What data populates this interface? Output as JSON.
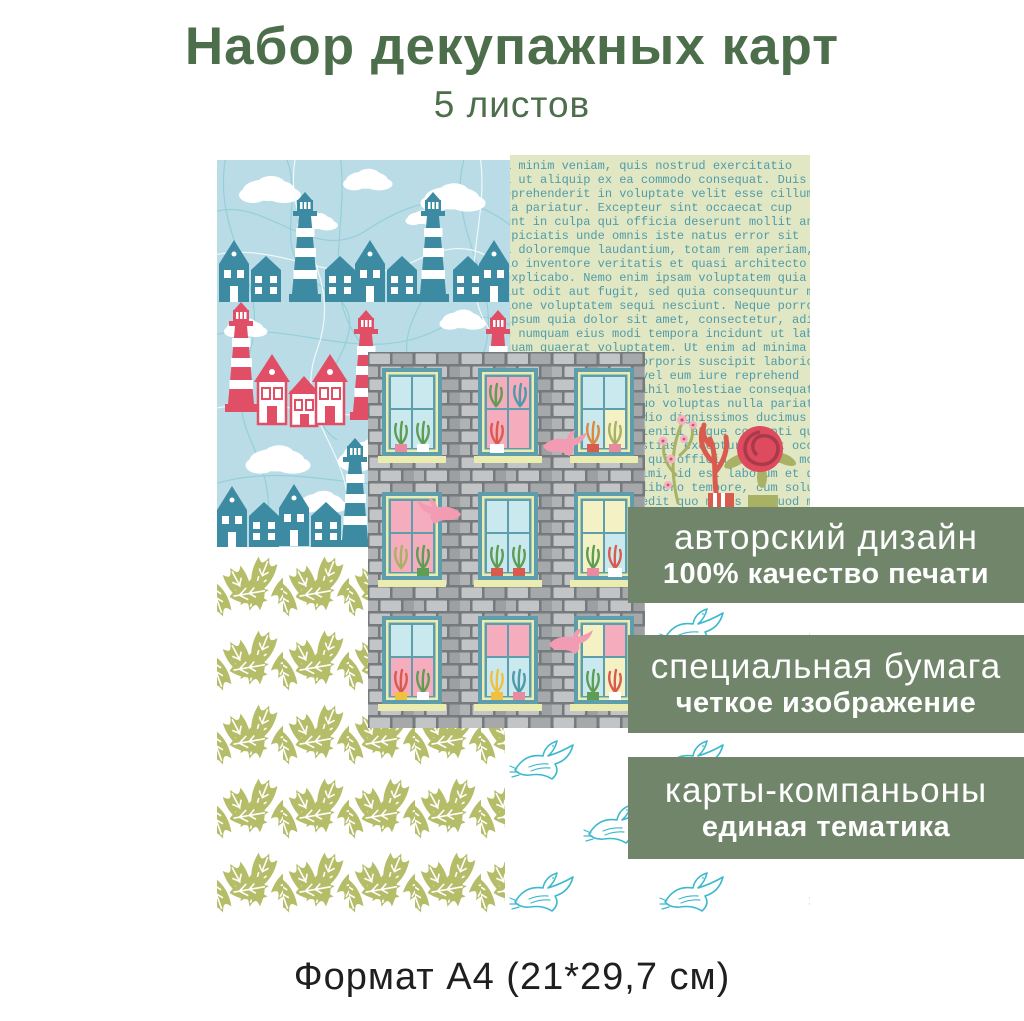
{
  "header": {
    "title": "Набор декупажных карт",
    "subtitle": "5 листов"
  },
  "badges": [
    {
      "line1": "авторский дизайн",
      "line2": "100% качество печати"
    },
    {
      "line1": "специальная бумага",
      "line2": "четкое изображение"
    },
    {
      "line1": "карты-компаньоны",
      "line2": "единая тематика"
    }
  ],
  "footer": {
    "format_label": "Формат А4 (21*29,7 см)"
  },
  "cards": {
    "houses_card": {
      "motifs": [
        "teal-houses",
        "striped-lighthouses",
        "red-lighthouses",
        "clouds",
        "scribble-lines"
      ]
    },
    "text_card": {
      "motifs": [
        "typewriter-lorem-text",
        "blossom-branch",
        "coral-branch",
        "rose-flower",
        "flower-pots"
      ],
      "lines": [
        "a minim veniam, quis nostrud exercitatio",
        "i ut aliquip ex ea commodo consequat. Duis",
        "eprehenderit in voluptate velit esse cillum",
        "la pariatur. Excepteur sint occaecat cup",
        "unt in culpa qui officia deserunt mollit anim id e",
        "spiciatis unde omnis iste natus error sit",
        "a doloremque laudantium, totam rem aperiam,",
        "lo inventore veritatis et quasi architecto be",
        "explicabo. Nemo enim ipsam voluptatem quia v",
        "aut odit aut fugit, sed quia consequuntur ma",
        "ione voluptatem sequi nesciunt. Neque porro qu",
        "ipsum quia dolor sit amet, consectetur, adip",
        "n numquam eius modi tempora incidunt ut labor",
        "quam quaerat voluptatem. Ut enim ad minima v",
        "rcitationem ullam corporis suscipit laborios",
        "quatur? Quis autem vel eum iure reprehend",
        "e velit esse quam nihil molestiae consequatur",
        "olorem eum fugiat quo voluptas nulla pariatur",
        "ccusamus et iusto odio dignissimos ducimus",
        "atium voluptatum deleniti atque corrupti quos",
        "olores et quas molestias excepturi sint occae",
        "lique sunt in culpa qui officia deserunt moll",
        "eserunt mollitia animi, id est laborum et dol",
        "ta distinctio. Nam libero tempore, cum solut",
        "io cumque nihil impedit quo minus id quod ma",
        "e placeat facere possimus, omnis voluptas ass",
        "r repellendus. Temporibus autem quibusdam",
        "et aut officiis debitis aut rerum necessitatib",
        "saepe eveniet ut et voluptates repudiandae",
        "int et molestiae non recusandae. Itaque ear",
        "rum hic tenetur a sapiente delectus, ut aut",
        "reiciendis voluptatibus maiores alias conse"
      ]
    },
    "building_card": {
      "motifs": [
        "brick-wall",
        "windows-with-plants",
        "pink-doves"
      ]
    },
    "leaves_card": {
      "motifs": [
        "olive-leaves-pattern"
      ]
    },
    "doves_card": {
      "motifs": [
        "outlined-doves-pattern"
      ]
    }
  },
  "colors": {
    "title_green": "#4d6e4b",
    "badge_green": "#70856a",
    "card_sky_blue": "#b9dce6",
    "teal_houses": "#3d8ba3",
    "red_lighthouse": "#e14f66",
    "text_card_bg": "#e1e6c3",
    "typewriter_teal": "#4f9caa",
    "leaf_olive": "#b5bd68",
    "dove_outline": "#3cb9cd",
    "window_teal": "#5e9dab",
    "bird_pink": "#f19cb2"
  }
}
